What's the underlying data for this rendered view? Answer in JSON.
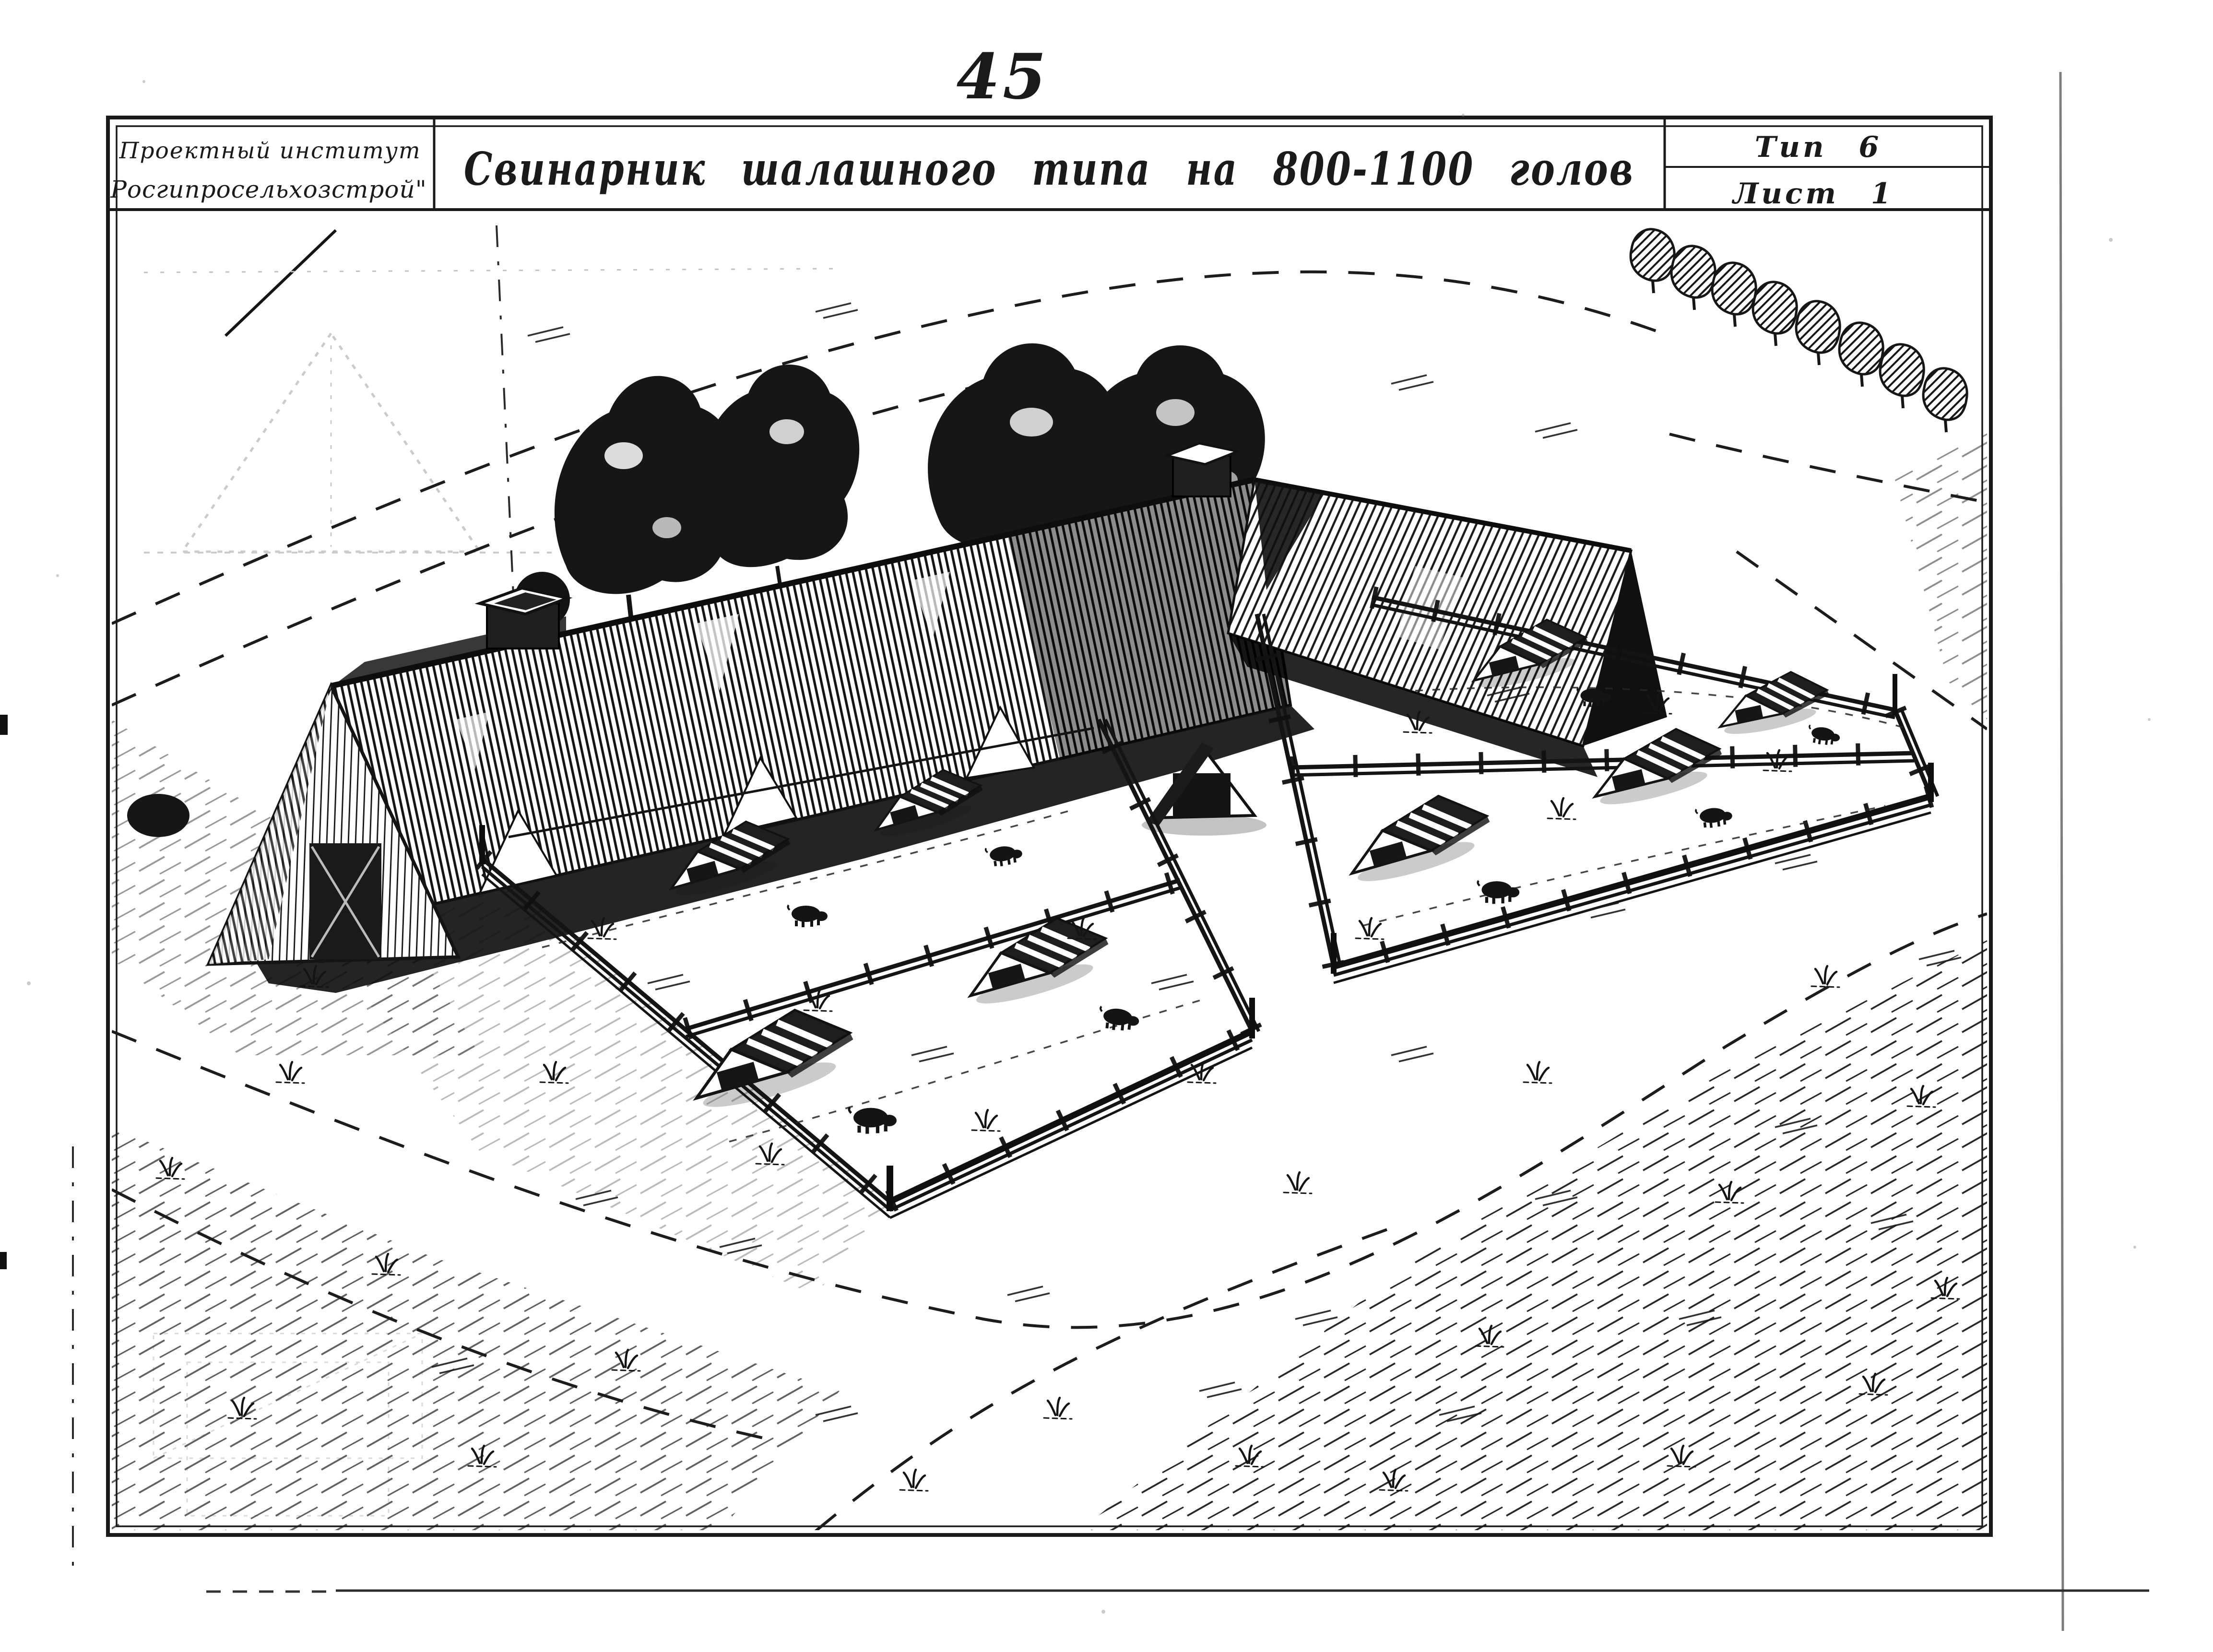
{
  "page": {
    "number": "45"
  },
  "colors": {
    "paper": "#ffffff",
    "ink": "#1a1a1a",
    "ghost": "#c2c2c2"
  },
  "title_block": {
    "institute_line1": "Проектный институт",
    "institute_line2": "Росгипросельхозстрой\"",
    "title": "Свинарник шалашного типа на 800-1100 голов",
    "type_label": "Тип 6",
    "sheet_label": "Лист 1"
  },
  "drawing": {
    "elements": [
      "a-frame-pig-barn",
      "ridge-vent-chimneys",
      "entrance-vestibule",
      "gable-end-door",
      "tree-clusters",
      "tree-row",
      "paddock-rail-fences",
      "pasture-pens",
      "pig-shelter-huts",
      "pigs",
      "dirt-roads",
      "grass-tufts",
      "ghost-bleedthrough-sketch"
    ]
  }
}
